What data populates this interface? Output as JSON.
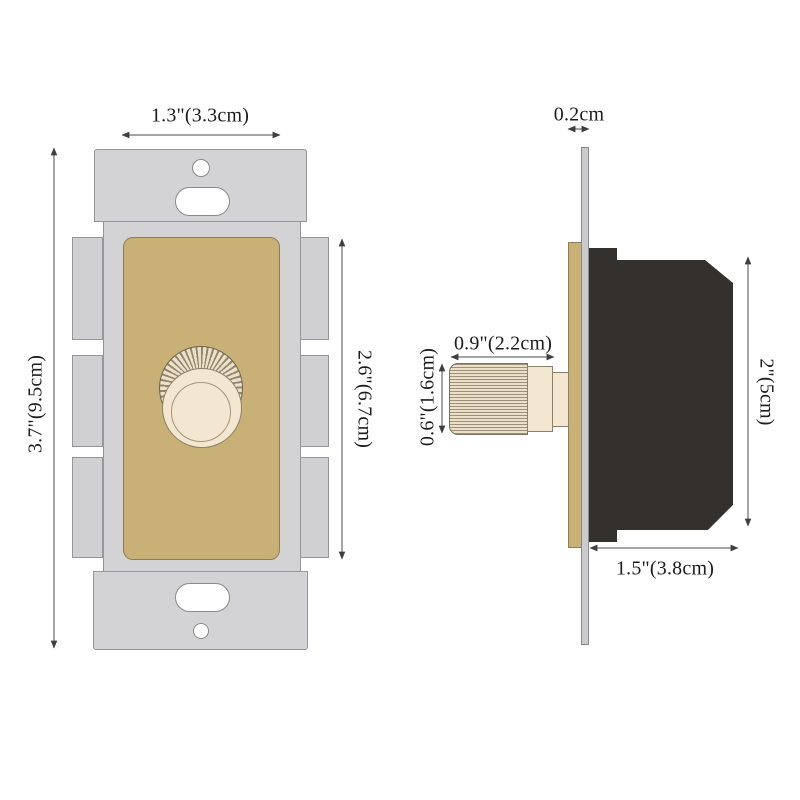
{
  "diagram": {
    "title": "rotary-dimmer-switch-dimension-diagram",
    "front_view": {
      "plate_width_label": "1.3\"(3.3cm)",
      "overall_height_label": "3.7\"(9.5cm)",
      "faceplate_height_label": "2.6\"(6.7cm)"
    },
    "side_view": {
      "wallplate_thickness_label": "0.2cm",
      "knob_depth_label": "0.9\"(2.2cm)",
      "knob_diameter_label": "0.6\"(1.6cm)",
      "body_height_label": "2\"(5cm)",
      "body_depth_label": "1.5\"(3.8cm)"
    },
    "colors": {
      "bracket_gray": "#d3d3d5",
      "faceplate_tan": "#c8b077",
      "knob_cream": "#f3e7d1",
      "body_dark": "#33302d",
      "dimension_line": "#4a4a4a",
      "background": "#ffffff"
    }
  }
}
